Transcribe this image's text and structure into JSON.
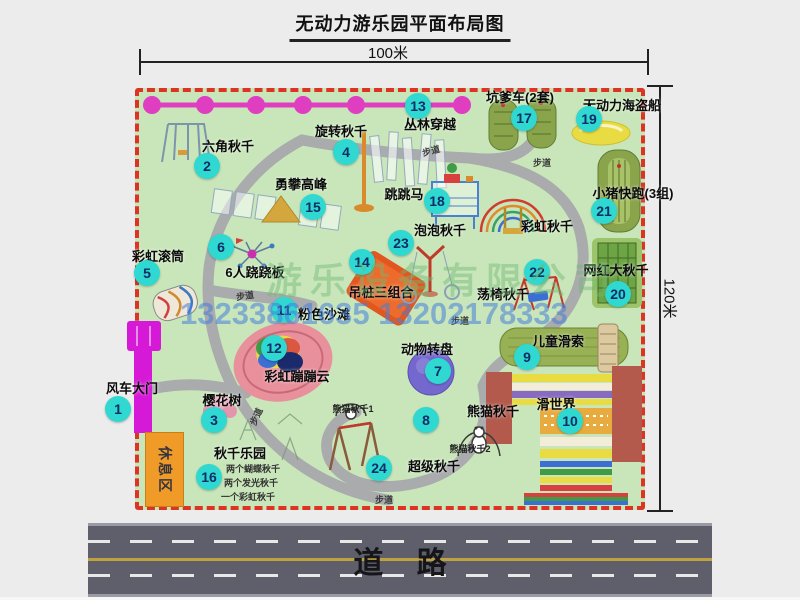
{
  "title": "无动力游乐园平面布局图",
  "dims": {
    "top": "100米",
    "right": "120米"
  },
  "road": {
    "label": "道    路"
  },
  "watermark": {
    "company": "游乐设备有限公司",
    "phone": "13233861635 13202178333"
  },
  "map": {
    "trail_label": "步道"
  },
  "rest_area_label": "休息区",
  "colors": {
    "badge": "#2fd8d0",
    "border_dash": "#dd3322",
    "chain": "#df3ec0",
    "park_green": "#c9e6ba"
  },
  "pois": [
    {
      "num": "1",
      "label": "风车大门"
    },
    {
      "num": "2",
      "label": "六角秋千"
    },
    {
      "num": "3",
      "label": "樱花树"
    },
    {
      "num": "4",
      "label": "旋转秋千"
    },
    {
      "num": "5",
      "label": "彩虹滚筒"
    },
    {
      "num": "6",
      "label": "6人跷跷板"
    },
    {
      "num": "7",
      "label": "动物转盘"
    },
    {
      "num": "8",
      "label": "熊猫秋千",
      "sub1": "熊猫秋千1",
      "sub2": "熊猫秋千2"
    },
    {
      "num": "9",
      "label": "儿童滑索"
    },
    {
      "num": "10",
      "label": "滑世界"
    },
    {
      "num": "11",
      "label": "粉色沙滩"
    },
    {
      "num": "12",
      "label": "彩虹蹦蹦云"
    },
    {
      "num": "13",
      "label": "丛林穿越"
    },
    {
      "num": "14",
      "label": "吊桩三组合"
    },
    {
      "num": "15",
      "label": "勇攀高峰"
    },
    {
      "num": "16",
      "label": "秋千乐园",
      "notes": [
        "两个蝴蝶秋千",
        "两个发光秋千",
        "一个彩虹秋千"
      ]
    },
    {
      "num": "17",
      "label": "坑爹车(2套)"
    },
    {
      "num": "18",
      "label": "跳跳马"
    },
    {
      "num": "19",
      "label": "无动力海盗船"
    },
    {
      "num": "20",
      "label": "网红大秋千"
    },
    {
      "num": "21",
      "label": "小猪快跑(3组)"
    },
    {
      "num": "22",
      "label": "荡椅秋千"
    },
    {
      "num": "23",
      "label": "泡泡秋千"
    },
    {
      "num": "24",
      "label": "超级秋千"
    },
    {
      "num": "",
      "label": "彩虹秋千"
    }
  ]
}
